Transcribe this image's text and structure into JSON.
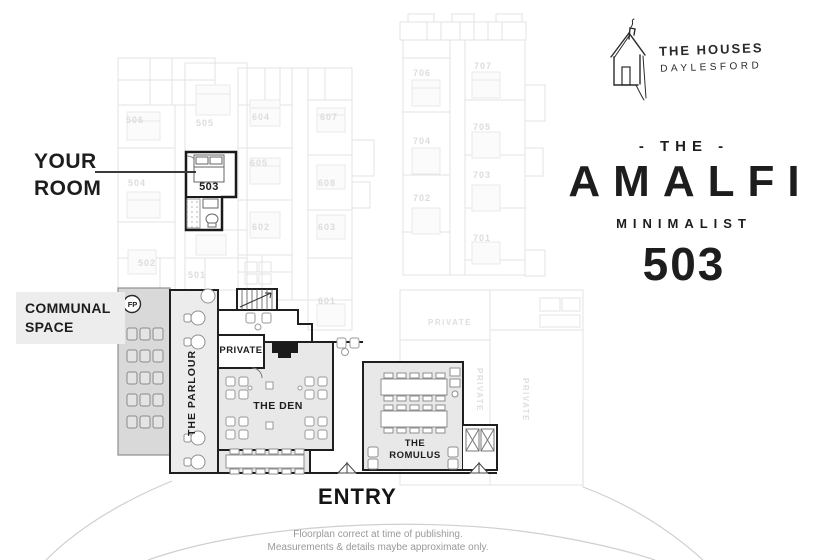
{
  "brand": {
    "logo_line1": "THE HOUSES",
    "logo_line2": "DAYLESFORD",
    "prefix": "- THE -",
    "name": "AMALFI",
    "style": "MINIMALIST",
    "room_number": "503"
  },
  "callouts": {
    "your_room_line1": "YOUR",
    "your_room_line2": "ROOM",
    "communal_line1": "COMMUNAL",
    "communal_line2": "SPACE",
    "entry": "ENTRY"
  },
  "plan": {
    "highlight_room_label": "503",
    "areas": {
      "parlour": "THE PARLOUR",
      "private": "PRIVATE",
      "den": "THE DEN",
      "romulus_line1": "THE",
      "romulus_line2": "ROMULUS",
      "fireplace_badge": "FP"
    },
    "rooms": {
      "r501": "501",
      "r502": "502",
      "r504": "504",
      "r505": "505",
      "r506": "506",
      "r601": "601",
      "r602": "602",
      "r603": "603",
      "r604": "604",
      "r605": "605",
      "r607": "607",
      "r608": "608",
      "r701": "701",
      "r702": "702",
      "r703": "703",
      "r704": "704",
      "r705": "705",
      "r706": "706",
      "r707": "707"
    },
    "faded_labels": {
      "private_upper": "PRIVATE",
      "private_v1": "PRIVATE",
      "private_v2": "PRIVATE"
    }
  },
  "footer": {
    "line1": "Floorplan correct at time of publishing.",
    "line2": "Measurements & details maybe approximate only."
  },
  "colors": {
    "ink": "#1d1d1d",
    "faded_line": "#e3e3e3",
    "area_fill": "#e8e8e8",
    "lounge_fill": "#d9d9d9",
    "muted_text": "#999999"
  }
}
